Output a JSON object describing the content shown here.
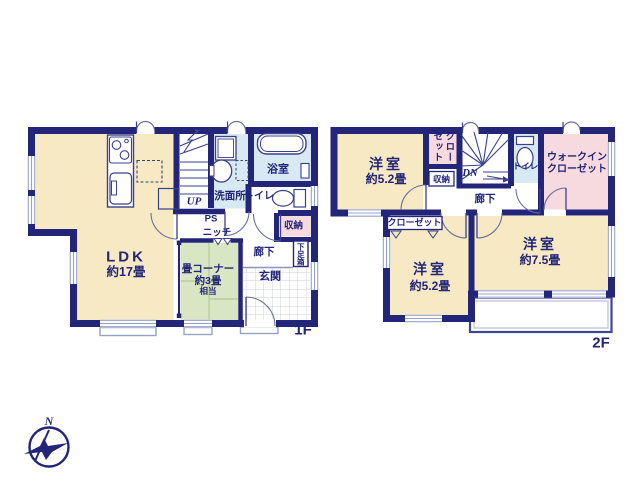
{
  "colors": {
    "bg": "#ffffff",
    "wall": "#232579",
    "text": "#232579",
    "room_cream": "#f7e9c4",
    "tatami_green": "#d9e6c3",
    "wet_blue": "#d8e9f3",
    "storage_pink": "#f7d9e0",
    "window_line": "#96a3c8",
    "thin_line": "#39408c",
    "arc_line": "#6a6f9d",
    "light_line": "#9aa3c0",
    "checker_line": "#ccd2e0",
    "tatami_line": "#b9c79b"
  },
  "floor1": {
    "label": "1F",
    "rooms": {
      "ldk": {
        "name": "LDK",
        "size": "約17畳"
      },
      "tatami": {
        "name": "畳コーナー",
        "size": "約3畳",
        "note": "相当"
      },
      "washroom": "洗面所",
      "bath": "浴室",
      "toilet": "トイレ",
      "storage": "収納",
      "hallway": "廊下",
      "entrance": "玄関",
      "shoe_box": "下足箱",
      "pipe_space": "PS",
      "niche": "ニッチ",
      "stairs": "UP"
    }
  },
  "floor2": {
    "label": "2F",
    "rooms": {
      "bedroom_a": {
        "name": "洋室",
        "size": "約5.2畳"
      },
      "closet_a": "クローゼット",
      "storage": "収納",
      "stairs": "DN",
      "toilet": "トイレ",
      "wic": {
        "line1": "ウォークイン",
        "line2": "クローゼット"
      },
      "hallway": "廊下",
      "closet_b": "クローゼット",
      "bedroom_b": {
        "name": "洋室",
        "size": "約5.2畳"
      },
      "bedroom_c": {
        "name": "洋室",
        "size": "約7.5畳"
      }
    }
  },
  "compass": {
    "north": "N"
  }
}
